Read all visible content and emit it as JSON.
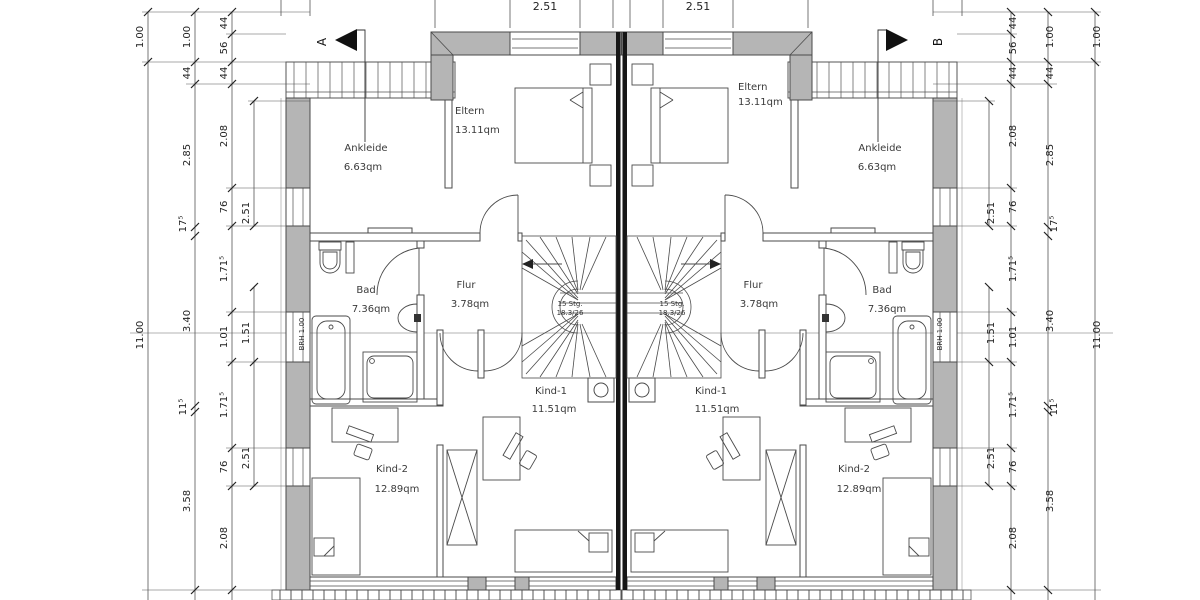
{
  "plan": {
    "kind": "floor-plan",
    "rooms": {
      "eltern": {
        "name": "Eltern",
        "area": "13.11qm"
      },
      "ankleide": {
        "name": "Ankleide",
        "area": "6.63qm"
      },
      "bad": {
        "name": "Bad",
        "area": "7.36qm"
      },
      "flur": {
        "name": "Flur",
        "area": "3.78qm"
      },
      "kind1": {
        "name": "Kind-1",
        "area": "11.51qm"
      },
      "kind2": {
        "name": "Kind-2",
        "area": "12.89qm"
      }
    },
    "stairs": {
      "steps": "15 Stg.",
      "rise_run": "18.3/26"
    },
    "annotations": {
      "sill": "BRH 1.00",
      "section_a": "A",
      "section_b": "B"
    },
    "dims": {
      "top": [
        "2.51",
        "2.51"
      ],
      "total": [
        "1.00",
        "11.00"
      ],
      "main": [
        "1.00",
        "44",
        "2.85",
        "17⁵",
        "3.40",
        "11⁵",
        "3.58"
      ],
      "detail": [
        "44",
        "56",
        "44",
        "2.08",
        "76",
        "1.71⁵",
        "1.01",
        "1.71⁵",
        "76",
        "2.08"
      ],
      "windows": [
        "2.51",
        "1.51",
        "2.51"
      ]
    },
    "colors": {
      "wall_fill": "#b5b5b5",
      "party_wall": "#161616",
      "line": "#4a4a4a",
      "dim_line": "#555555",
      "background": "#ffffff"
    }
  }
}
